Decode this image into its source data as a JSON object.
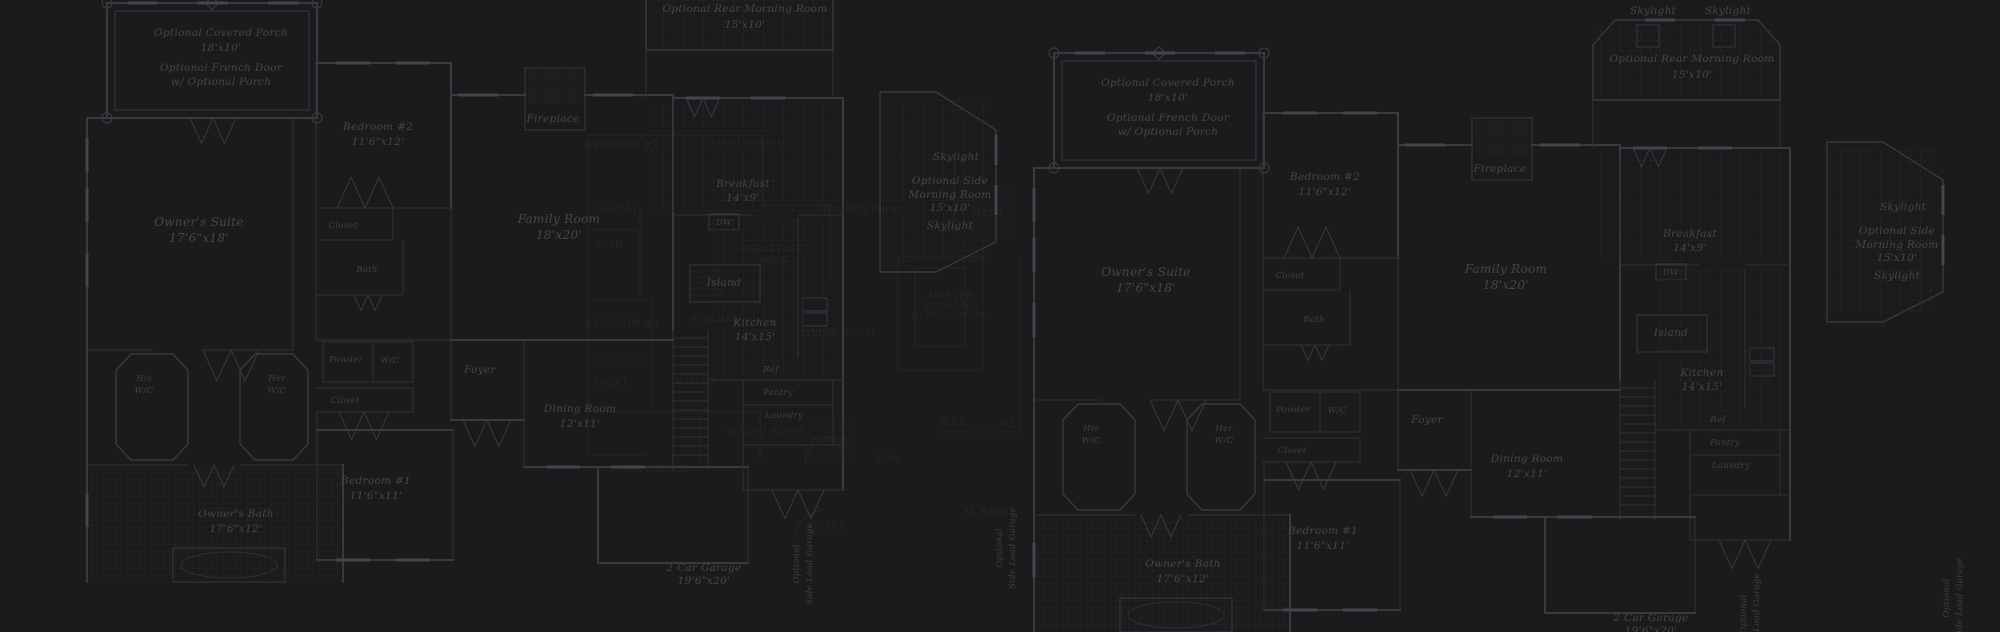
{
  "canvas": {
    "width": 2000,
    "height": 632,
    "background": "#1b1b1d"
  },
  "colors": {
    "background": "#1b1b1d",
    "wall_line": "#3a3a3e",
    "thin_line": "#313135",
    "hatch_line": "#242428",
    "label_text": "#46464b",
    "dim_label_text": "#404045",
    "background_plan": "#2f2f33"
  },
  "instances": [
    {
      "name": "left",
      "dx": -947,
      "dy": -50
    },
    {
      "name": "right",
      "dx": 0,
      "dy": 0
    }
  ],
  "plan": {
    "walls": [
      [
        1034,
        168,
        1034,
        632,
        2
      ],
      [
        1034,
        168,
        1263,
        168,
        2
      ],
      [
        1240,
        168,
        1240,
        400,
        1
      ],
      [
        1263,
        113,
        1398,
        113,
        2
      ],
      [
        1263,
        113,
        1263,
        345,
        1
      ],
      [
        1398,
        113,
        1398,
        258,
        2
      ],
      [
        1263,
        258,
        1398,
        258,
        1
      ],
      [
        1263,
        290,
        1340,
        290,
        1
      ],
      [
        1340,
        258,
        1340,
        290,
        1
      ],
      [
        1263,
        345,
        1350,
        345,
        1
      ],
      [
        1350,
        290,
        1350,
        345,
        1
      ],
      [
        1263,
        345,
        1263,
        390,
        1
      ],
      [
        1263,
        390,
        1398,
        390,
        1
      ],
      [
        1398,
        145,
        1472,
        145,
        2
      ],
      [
        1532,
        145,
        1620,
        145,
        2
      ],
      [
        1398,
        258,
        1398,
        390,
        1
      ],
      [
        1398,
        390,
        1620,
        390,
        2
      ],
      [
        1620,
        145,
        1620,
        380,
        2
      ],
      [
        1620,
        148,
        1790,
        148,
        2
      ],
      [
        1790,
        148,
        1790,
        540,
        2
      ],
      [
        1620,
        265,
        1700,
        265,
        1
      ],
      [
        1745,
        265,
        1790,
        265,
        1
      ],
      [
        1745,
        268,
        1745,
        408,
        1
      ],
      [
        1593,
        100,
        1593,
        148,
        1
      ],
      [
        1780,
        100,
        1780,
        148,
        1
      ],
      [
        1620,
        380,
        1620,
        520,
        1
      ],
      [
        1655,
        380,
        1655,
        520,
        1
      ],
      [
        1270,
        392,
        1360,
        392,
        1
      ],
      [
        1270,
        432,
        1360,
        432,
        1
      ],
      [
        1270,
        392,
        1270,
        432,
        1
      ],
      [
        1320,
        392,
        1320,
        432,
        1
      ],
      [
        1360,
        392,
        1360,
        432,
        1
      ],
      [
        1263,
        438,
        1360,
        438,
        1
      ],
      [
        1263,
        462,
        1360,
        462,
        1
      ],
      [
        1360,
        438,
        1360,
        462,
        1
      ],
      [
        1264,
        480,
        1400,
        480,
        2
      ],
      [
        1400,
        480,
        1400,
        610,
        1
      ],
      [
        1264,
        610,
        1400,
        610,
        2
      ],
      [
        1264,
        462,
        1264,
        610,
        1
      ],
      [
        1398,
        390,
        1398,
        470,
        1
      ],
      [
        1398,
        470,
        1471,
        470,
        2
      ],
      [
        1471,
        390,
        1471,
        517,
        1
      ],
      [
        1471,
        517,
        1616,
        517,
        2
      ],
      [
        1545,
        517,
        1545,
        613,
        2
      ],
      [
        1695,
        517,
        1695,
        613,
        1
      ],
      [
        1545,
        613,
        1695,
        613,
        2
      ],
      [
        1616,
        517,
        1695,
        517,
        2
      ],
      [
        1655,
        430,
        1790,
        430,
        1
      ],
      [
        1690,
        430,
        1690,
        495,
        1
      ],
      [
        1690,
        455,
        1780,
        455,
        1
      ],
      [
        1780,
        430,
        1780,
        495,
        1
      ],
      [
        1690,
        495,
        1790,
        495,
        1
      ],
      [
        1690,
        495,
        1690,
        540,
        1
      ],
      [
        1690,
        540,
        1790,
        540,
        1
      ],
      [
        1034,
        400,
        1100,
        400,
        1
      ],
      [
        1150,
        400,
        1240,
        400,
        1
      ],
      [
        1034,
        515,
        1135,
        515,
        1
      ],
      [
        1187,
        515,
        1290,
        515,
        1
      ],
      [
        1290,
        515,
        1290,
        632,
        2
      ]
    ],
    "rects": [
      {
        "x": 1054,
        "y": 53,
        "w": 210,
        "h": 115,
        "sw": 2,
        "name": "porch-outline"
      },
      {
        "x": 1062,
        "y": 61,
        "w": 194,
        "h": 99,
        "sw": 1,
        "name": "porch-inner-outline"
      },
      {
        "x": 1472,
        "y": 118,
        "w": 60,
        "h": 62,
        "sw": 1,
        "name": "fireplace-box"
      },
      {
        "x": 1637,
        "y": 25,
        "w": 22,
        "h": 22,
        "sw": 1,
        "name": "skylight-box"
      },
      {
        "x": 1713,
        "y": 25,
        "w": 22,
        "h": 22,
        "sw": 1,
        "name": "skylight-box"
      },
      {
        "x": 1637,
        "y": 315,
        "w": 70,
        "h": 37,
        "sw": 1,
        "name": "island-counter"
      },
      {
        "x": 1656,
        "y": 264,
        "w": 30,
        "h": 16,
        "sw": 1,
        "name": "dishwasher-box"
      },
      {
        "x": 1750,
        "y": 348,
        "w": 24,
        "h": 13,
        "sw": 1,
        "name": "oven-box"
      },
      {
        "x": 1750,
        "y": 363,
        "w": 24,
        "h": 13,
        "sw": 1,
        "name": "oven-box"
      }
    ],
    "polys": [
      {
        "pts": "1593,45 1615,20 1758,20 1780,45 1780,100 1593,100",
        "name": "rear-morning-room-outline"
      },
      {
        "pts": "1827,142 1883,142 1943,180 1943,292 1883,322 1827,322",
        "name": "side-morning-room-outline"
      },
      {
        "pts": "1063,420 1078,404 1120,404 1135,420 1135,494 1120,510 1078,510 1063,494",
        "name": "his-wc-outline"
      },
      {
        "pts": "1187,420 1202,404 1240,404 1255,420 1255,494 1240,510 1202,510 1187,494",
        "name": "her-wc-outline"
      }
    ],
    "circles": [
      [
        1054,
        53
      ],
      [
        1264,
        53
      ],
      [
        1054,
        168
      ],
      [
        1264,
        168
      ]
    ],
    "diamonds": [
      [
        1159,
        53
      ]
    ],
    "hatches": [
      {
        "x": 1596,
        "y": 23,
        "w": 182,
        "h": 75,
        "p": "g10",
        "name": "rear-morning-room-floor"
      },
      {
        "x": 1830,
        "y": 150,
        "w": 106,
        "h": 164,
        "p": "g10",
        "name": "side-morning-room-floor"
      },
      {
        "x": 1598,
        "y": 152,
        "w": 188,
        "h": 110,
        "p": "g10",
        "name": "breakfast-floor"
      },
      {
        "x": 1658,
        "y": 268,
        "w": 130,
        "h": 158,
        "p": "g10",
        "name": "kitchen-floor"
      },
      {
        "x": 1036,
        "y": 518,
        "w": 252,
        "h": 112,
        "p": "g6",
        "name": "owners-bath-floor"
      },
      {
        "x": 1474,
        "y": 120,
        "w": 56,
        "h": 34,
        "p": "g3",
        "name": "fireplace-hatch"
      }
    ],
    "windows": [
      [
        1090,
        53,
        30,
        "h"
      ],
      [
        1160,
        53,
        30,
        "h"
      ],
      [
        1230,
        53,
        30,
        "h"
      ],
      [
        1034,
        205,
        34,
        "v"
      ],
      [
        1034,
        255,
        34,
        "v"
      ],
      [
        1034,
        320,
        34,
        "v"
      ],
      [
        1034,
        560,
        34,
        "v"
      ],
      [
        1300,
        113,
        34,
        "h"
      ],
      [
        1360,
        113,
        34,
        "h"
      ],
      [
        1425,
        145,
        40,
        "h"
      ],
      [
        1560,
        145,
        40,
        "h"
      ],
      [
        1650,
        148,
        34,
        "h"
      ],
      [
        1715,
        148,
        34,
        "h"
      ],
      [
        1660,
        20,
        30,
        "h"
      ],
      [
        1730,
        20,
        30,
        "h"
      ],
      [
        1943,
        200,
        30,
        "v"
      ],
      [
        1943,
        250,
        30,
        "v"
      ],
      [
        1510,
        517,
        34,
        "h"
      ],
      [
        1575,
        517,
        34,
        "h"
      ],
      [
        1300,
        610,
        34,
        "h"
      ],
      [
        1360,
        610,
        34,
        "h"
      ]
    ],
    "doors": [
      [
        1160,
        168,
        46,
        -1
      ],
      [
        1312,
        258,
        56,
        1
      ],
      [
        1178,
        400,
        56,
        -1
      ],
      [
        1311,
        462,
        50,
        -1
      ],
      [
        1434,
        470,
        48,
        -1
      ],
      [
        1161,
        515,
        40,
        -1
      ],
      [
        1650,
        148,
        34,
        -1
      ],
      [
        1745,
        540,
        52,
        -1
      ],
      [
        1315,
        345,
        28,
        -1
      ]
    ],
    "treads": {
      "x1": 1620,
      "x2": 1655,
      "y1": 388,
      "y2": 512,
      "step": 9
    },
    "tub": {
      "x": 1120,
      "y": 598,
      "w": 112,
      "h": 34
    },
    "labels": [
      {
        "t": "Skylight",
        "x": 1653,
        "y": 14,
        "s": "md"
      },
      {
        "t": "Skylight",
        "x": 1728,
        "y": 14,
        "s": "md"
      },
      {
        "t": "Optional Rear Morning Room",
        "x": 1692,
        "y": 62,
        "s": "md"
      },
      {
        "t": "15'x10'",
        "x": 1692,
        "y": 78,
        "s": "md"
      },
      {
        "t": "Optional Covered Porch",
        "x": 1168,
        "y": 86,
        "s": "md"
      },
      {
        "t": "18'x10'",
        "x": 1168,
        "y": 101,
        "s": "md"
      },
      {
        "t": "Optional French Door",
        "x": 1168,
        "y": 121,
        "s": "md"
      },
      {
        "t": "w/ Optional Porch",
        "x": 1168,
        "y": 135,
        "s": "md"
      },
      {
        "t": "Bedroom #2",
        "x": 1325,
        "y": 180,
        "s": "md"
      },
      {
        "t": "11'6\"x12'",
        "x": 1325,
        "y": 195,
        "s": "md"
      },
      {
        "t": "Fireplace",
        "x": 1500,
        "y": 172,
        "s": "md"
      },
      {
        "t": "Owner's Suite",
        "x": 1146,
        "y": 276,
        "s": "lg"
      },
      {
        "t": "17'6\"x18'",
        "x": 1146,
        "y": 292,
        "s": "lg"
      },
      {
        "t": "Family Room",
        "x": 1506,
        "y": 273,
        "s": "lg"
      },
      {
        "t": "18'x20'",
        "x": 1506,
        "y": 289,
        "s": "lg"
      },
      {
        "t": "Breakfast",
        "x": 1690,
        "y": 237,
        "s": "md"
      },
      {
        "t": "14'x9'",
        "x": 1690,
        "y": 251,
        "s": "md"
      },
      {
        "t": "DW",
        "x": 1671,
        "y": 275,
        "s": "sm"
      },
      {
        "t": "Island",
        "x": 1671,
        "y": 336,
        "s": "md"
      },
      {
        "t": "Kitchen",
        "x": 1702,
        "y": 376,
        "s": "md"
      },
      {
        "t": "14'x15'",
        "x": 1702,
        "y": 390,
        "s": "md"
      },
      {
        "t": "Ref",
        "x": 1718,
        "y": 422,
        "s": "sm"
      },
      {
        "t": "Pantry",
        "x": 1725,
        "y": 445,
        "s": "sm"
      },
      {
        "t": "Laundry",
        "x": 1731,
        "y": 468,
        "s": "sm"
      },
      {
        "t": "Closet",
        "x": 1290,
        "y": 278,
        "s": "sm"
      },
      {
        "t": "Bath",
        "x": 1314,
        "y": 322,
        "s": "sm"
      },
      {
        "t": "His",
        "x": 1091,
        "y": 431,
        "s": "sm"
      },
      {
        "t": "W/C",
        "x": 1091,
        "y": 443,
        "s": "sm"
      },
      {
        "t": "Her",
        "x": 1224,
        "y": 431,
        "s": "sm"
      },
      {
        "t": "W/C",
        "x": 1224,
        "y": 443,
        "s": "sm"
      },
      {
        "t": "Powder",
        "x": 1293,
        "y": 412,
        "s": "sm"
      },
      {
        "t": "W/C",
        "x": 1337,
        "y": 413,
        "s": "sm"
      },
      {
        "t": "Closet",
        "x": 1292,
        "y": 453,
        "s": "sm"
      },
      {
        "t": "Foyer",
        "x": 1427,
        "y": 423,
        "s": "md"
      },
      {
        "t": "Dining Room",
        "x": 1527,
        "y": 462,
        "s": "md"
      },
      {
        "t": "12'x11'",
        "x": 1527,
        "y": 477,
        "s": "md"
      },
      {
        "t": "Bedroom #1",
        "x": 1323,
        "y": 534,
        "s": "md"
      },
      {
        "t": "11'6\"x11'",
        "x": 1323,
        "y": 549,
        "s": "md"
      },
      {
        "t": "Owner's Bath",
        "x": 1183,
        "y": 567,
        "s": "md"
      },
      {
        "t": "17'6\"x12'",
        "x": 1183,
        "y": 582,
        "s": "md"
      },
      {
        "t": "Skylight",
        "x": 1903,
        "y": 210,
        "s": "md"
      },
      {
        "t": "Optional Side",
        "x": 1897,
        "y": 234,
        "s": "md"
      },
      {
        "t": "Morning Room",
        "x": 1897,
        "y": 248,
        "s": "md"
      },
      {
        "t": "15'x10'",
        "x": 1897,
        "y": 261,
        "s": "md"
      },
      {
        "t": "Skylight",
        "x": 1897,
        "y": 279,
        "s": "md"
      },
      {
        "t": "2 Car Garage",
        "x": 1651,
        "y": 621,
        "s": "md"
      },
      {
        "t": "19'6\"x20'",
        "x": 1651,
        "y": 634,
        "s": "md"
      }
    ],
    "vlabels": [
      {
        "t": "Optional",
        "x": 1949,
        "y": 598
      },
      {
        "t": "Side Load Garage",
        "x": 1962,
        "y": 598
      },
      {
        "t": "Optional",
        "x": 1746,
        "y": 614
      },
      {
        "t": "Side Load Garage",
        "x": 1759,
        "y": 614
      }
    ]
  },
  "background_plan": {
    "lines": [
      [
        588,
        135,
        588,
        455
      ],
      [
        588,
        135,
        762,
        135
      ],
      [
        762,
        135,
        762,
        205
      ],
      [
        588,
        230,
        640,
        230
      ],
      [
        640,
        205,
        640,
        300
      ],
      [
        588,
        300,
        652,
        300
      ],
      [
        652,
        300,
        652,
        412
      ],
      [
        588,
        360,
        652,
        360
      ],
      [
        588,
        412,
        762,
        412
      ],
      [
        588,
        455,
        646,
        455
      ],
      [
        762,
        205,
        830,
        205
      ],
      [
        830,
        205,
        830,
        280
      ],
      [
        1020,
        255,
        1020,
        432
      ],
      [
        940,
        432,
        1020,
        432
      ],
      [
        898,
        160,
        955,
        160
      ],
      [
        955,
        160,
        955,
        230
      ],
      [
        700,
        412,
        700,
        460
      ],
      [
        760,
        412,
        760,
        460
      ]
    ],
    "rects": [
      {
        "x": 898,
        "y": 257,
        "w": 85,
        "h": 113,
        "name": "master-bedroom-outline"
      },
      {
        "x": 915,
        "y": 268,
        "w": 50,
        "h": 78,
        "name": "bed-symbol"
      }
    ],
    "arcs": [
      "M805,465 a28,28 0 0 1 28,-28",
      "M795,540 a30,30 0 0 1 30,-30"
    ],
    "treads": {
      "x1": 688,
      "x2": 722,
      "y1": 265,
      "y2": 300,
      "step": 6
    },
    "grids": [
      {
        "x": 806,
        "y": 420,
        "w": 48,
        "h": 40
      },
      {
        "x": 958,
        "y": 182,
        "w": 55,
        "h": 58
      }
    ],
    "labels": [
      {
        "t": "BEDROOM #2",
        "x": 622,
        "y": 148
      },
      {
        "t": "FAMILY ROOM",
        "x": 748,
        "y": 147
      },
      {
        "t": "CLOSET",
        "x": 617,
        "y": 210
      },
      {
        "t": "BATH",
        "x": 609,
        "y": 247
      },
      {
        "t": "BREAKFAST",
        "x": 772,
        "y": 252
      },
      {
        "t": "NOOK",
        "x": 772,
        "y": 263
      },
      {
        "t": "COVERED PATIO",
        "x": 859,
        "y": 213
      },
      {
        "t": "BATH",
        "x": 988,
        "y": 216
      },
      {
        "t": "KITCHEN",
        "x": 716,
        "y": 322
      },
      {
        "t": "LIVING ROOM",
        "x": 838,
        "y": 336
      },
      {
        "t": "MASTER",
        "x": 951,
        "y": 299
      },
      {
        "t": "BEDROOM",
        "x": 951,
        "y": 309
      },
      {
        "t": "W/ OPTIONAL BED",
        "x": 951,
        "y": 317,
        "s": "xs"
      },
      {
        "t": "BEDROOM #3",
        "x": 622,
        "y": 326
      },
      {
        "t": "CLOSET",
        "x": 607,
        "y": 386
      },
      {
        "t": "UTILITY",
        "x": 697,
        "y": 384
      },
      {
        "t": "DINING ROOM",
        "x": 765,
        "y": 434
      },
      {
        "t": "FOYER",
        "x": 829,
        "y": 443
      },
      {
        "t": "DEN",
        "x": 888,
        "y": 462
      },
      {
        "t": "W.I.C.",
        "x": 955,
        "y": 426
      },
      {
        "t": "W.I.C.",
        "x": 1014,
        "y": 427
      },
      {
        "t": "M. BATH",
        "x": 987,
        "y": 515
      },
      {
        "t": "ENTRY",
        "x": 827,
        "y": 529
      },
      {
        "t": "2 CAR GARAGE",
        "x": 650,
        "y": 472
      }
    ]
  }
}
